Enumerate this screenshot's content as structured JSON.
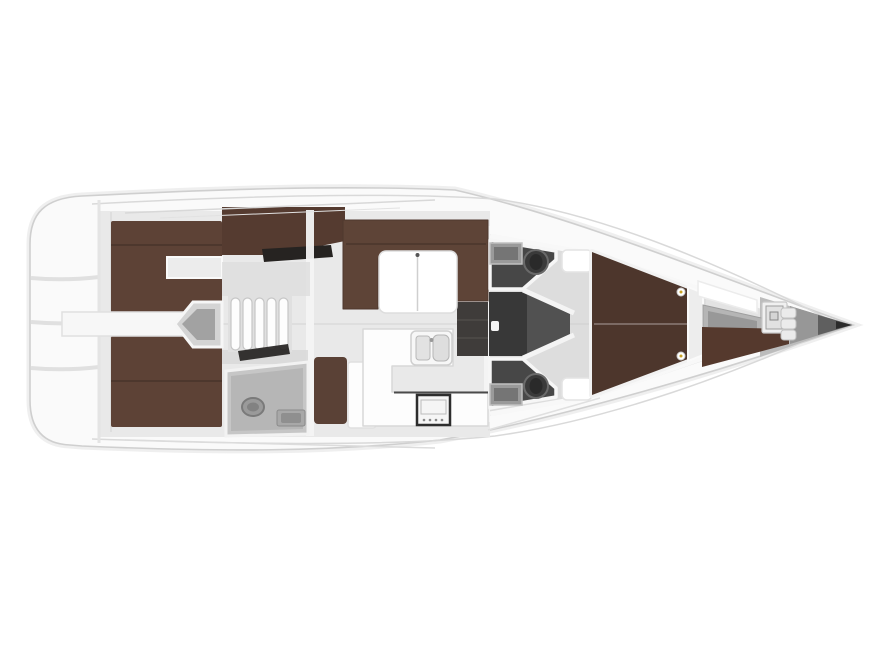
{
  "figure": {
    "type": "yacht-deck-plan-top-view",
    "orientation": "bow-right"
  },
  "colors": {
    "background": "#ffffff",
    "hull": "#fafafa",
    "hull_edge": "#cfcfcf",
    "hull_halo": "#ededed",
    "deck_line": "#d9d9d9",
    "floor": "#e9e9e9",
    "floor_forward": "#dddddd",
    "floor_forepeak": "#e3e3e3",
    "walkway_white": "#f7f7f7",
    "bulkhead_white": "#f4f4f4",
    "berth_brown": "#5d4236",
    "berth_brown_dark": "#4d362c",
    "settee_brown": "#5e4437",
    "seat_brown": "#5a4136",
    "extension_brown": "#553b30",
    "crew_berth_brown": "#55392d",
    "wardrobe_dark": "#262321",
    "doorway_dark": "#201e1d",
    "head_room": "#474747",
    "corridor": "#383838",
    "corridor_floor": "#515151",
    "locker_dark": "#3f3c3a",
    "aft_head_room": "#c6c6c6",
    "aft_head_floor": "#b6b6b6",
    "fixture_gray": "#9a9a9a",
    "fixture_dark": "#757575",
    "toilet_dark": "#3a3a3a",
    "furniture_white": "#fdfdfd",
    "table_white": "#ffffff",
    "step_white": "#fdfdfd",
    "stove_frame": "#2d2d2d",
    "counter_edge_dark": "#4a4a4a",
    "platform_gray": "#b5b5b5",
    "bow_gray_1": "#bcbcbc",
    "bow_gray_2": "#979797",
    "bow_gray_3": "#5f5f5f",
    "bow_tip": "#2b2b2b",
    "entry_gray": "#d4d4d4",
    "entry_inner_gray": "#a2a2a2",
    "lamp_accent": "#c9a227"
  }
}
